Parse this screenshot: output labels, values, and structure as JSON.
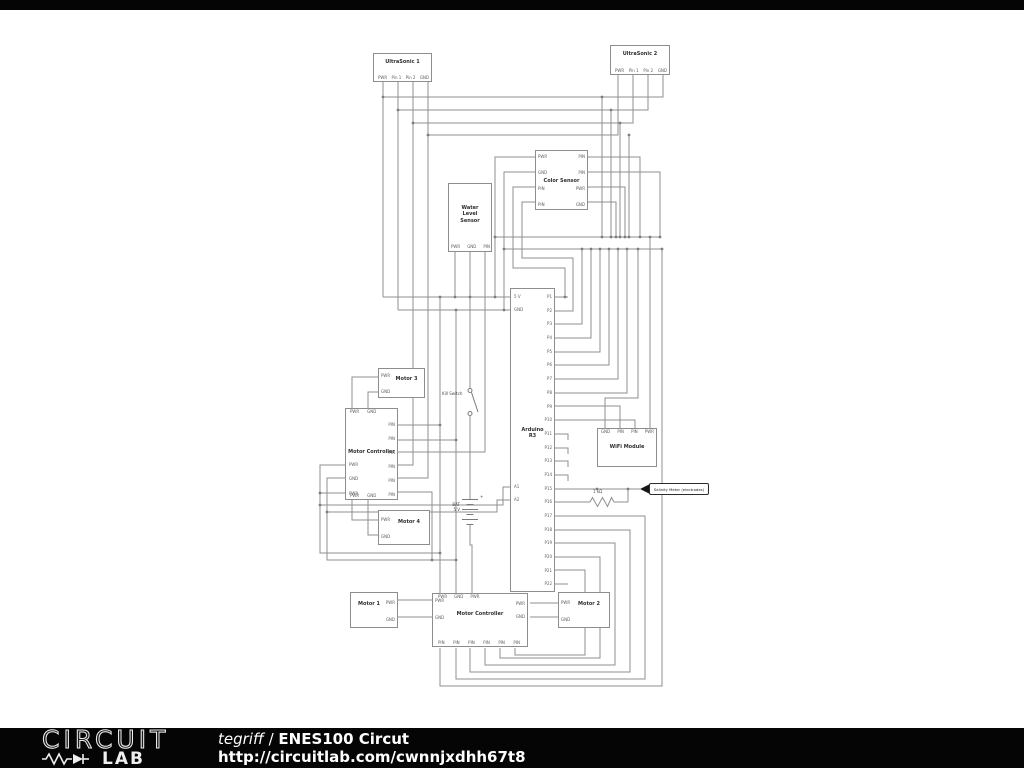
{
  "footer": {
    "logo_line1": "CIRCUIT",
    "logo_line2": "LAB",
    "author": "tegriff",
    "separator": " / ",
    "circuit_title": "ENES100 Circut",
    "url": "http://circuitlab.com/cwnnjxdhh67t8"
  },
  "colors": {
    "wire": "#8f8f8f",
    "box_border": "#8d8d8d",
    "footer_bg": "#050505",
    "canvas": "#ffffff"
  },
  "diagram": {
    "components": {
      "ultrasonic1": {
        "title": "UltraSonic 1",
        "pins_bottom": [
          "PWR",
          "Pin 1",
          "Pin 2",
          "GND"
        ]
      },
      "ultrasonic2": {
        "title": "UltraSonic 2",
        "pins_bottom": [
          "PWR",
          "Pin 1",
          "Pin 2",
          "GND"
        ]
      },
      "color_sensor": {
        "title": "Color Sensor",
        "pins_left": [
          "PWR",
          "GND",
          "PIN",
          "PIN"
        ],
        "pins_right": [
          "PIN",
          "PIN",
          "PWR",
          "GND"
        ]
      },
      "water_level_sensor": {
        "title_lines": [
          "Water",
          "Level",
          "Sensor"
        ],
        "pins_bottom": [
          "PWR",
          "GND",
          "PIN"
        ]
      },
      "arduino": {
        "title_lines": [
          "Arduino",
          "R3"
        ],
        "pins_left": [
          "5 V",
          "GND",
          "A1",
          "A2"
        ],
        "pins_right": [
          "P1",
          "P2",
          "P3",
          "P4",
          "P5",
          "P6",
          "P7",
          "P8",
          "P9",
          "P10",
          "P11",
          "P12",
          "P13",
          "P14",
          "P15",
          "P16",
          "P17",
          "P18",
          "P19",
          "P20",
          "P21",
          "P22"
        ]
      },
      "wifi_module": {
        "title": "WiFi Module",
        "pins_top": [
          "GND",
          "PIN",
          "PIN",
          "PWR"
        ]
      },
      "motor_controller_left": {
        "title": "Motor Controller",
        "pins_top": [
          "PWR",
          "GND"
        ],
        "pins_bottom": [
          "PWR",
          "GND"
        ],
        "pins_left": [
          "PWR",
          "GND",
          "PWR"
        ],
        "pins_right": [
          "PIN",
          "PIN",
          "PIN",
          "PIN",
          "PIN",
          "PIN"
        ]
      },
      "motor_controller_bottom": {
        "title": "Motor Controller",
        "pins_top": [
          "PWR",
          "GND",
          "PWR"
        ],
        "pins_left": [
          "PWR",
          "GND"
        ],
        "pins_right": [
          "PWR",
          "GND"
        ],
        "pins_bottom": [
          "PIN",
          "PIN",
          "PIN",
          "PIN",
          "PIN",
          "PIN"
        ]
      },
      "motor1": {
        "title": "Motor 1",
        "pins_right": [
          "PWR",
          "GND"
        ]
      },
      "motor2": {
        "title": "Motor 2",
        "pins_left": [
          "PWR",
          "GND"
        ]
      },
      "motor3": {
        "title": "Motor 3",
        "pins_left": [
          "PWR",
          "GND"
        ]
      },
      "motor4": {
        "title": "Motor 4",
        "pins_left": [
          "PWR",
          "GND"
        ]
      }
    },
    "annotations": {
      "kill_switch": "Kill Switch",
      "battery_lines": [
        "BAT",
        "5 V"
      ],
      "battery_plus": "+",
      "resistor_value": "1 kΩ",
      "salinity_flag": "Salinity Meter (electrodes)"
    }
  }
}
